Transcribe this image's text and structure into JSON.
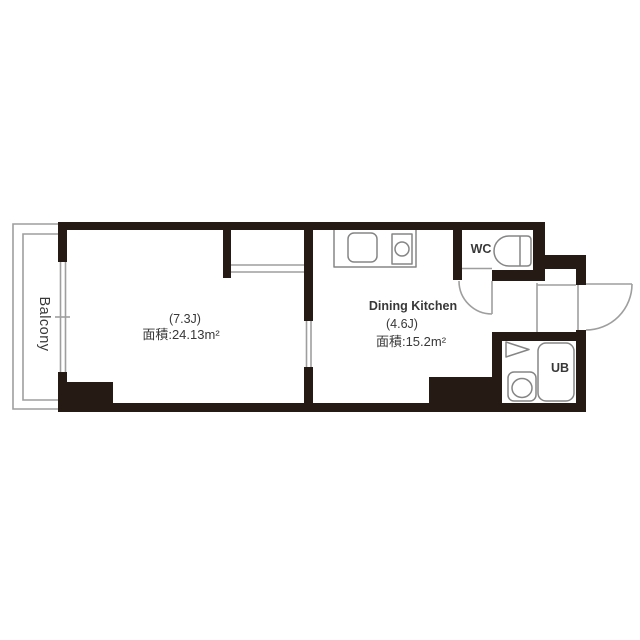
{
  "title": "apartment floor plan",
  "colors": {
    "wall": "#261b14",
    "fixture": "#858585",
    "line": "#9e9e9e",
    "text": "#383838",
    "background": "#ffffff"
  },
  "balcony": {
    "label": "Balcony"
  },
  "living_room": {
    "size": "(7.3J)",
    "area": "面積:24.13m²"
  },
  "dining_kitchen": {
    "name": "Dining Kitchen",
    "size": "(4.6J)",
    "area": "面積:15.2m²"
  },
  "wc": {
    "label": "WC"
  },
  "bath": {
    "label": "UB"
  }
}
